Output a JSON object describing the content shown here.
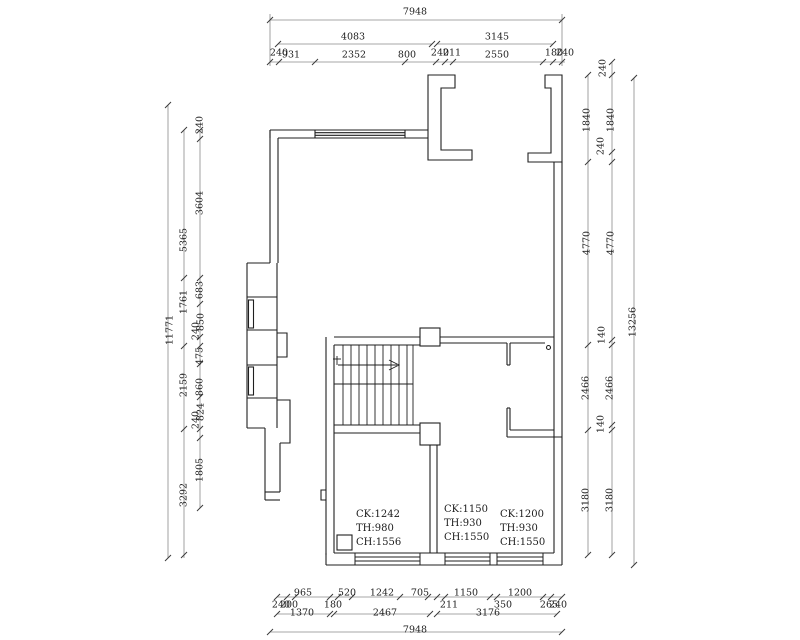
{
  "drawing_type": "floor-plan",
  "colors": {
    "wall_line": "#1f1f1f",
    "dim_line": "#6a6a6a",
    "text": "#1c1c1c",
    "background": "#ffffff"
  },
  "dimensions": {
    "top": {
      "total": "7948",
      "row2": [
        "4083",
        "3145"
      ],
      "row3": [
        "240",
        "931",
        "2352",
        "800",
        "240",
        "211",
        "2550",
        "180",
        "240"
      ]
    },
    "left": {
      "outer": "11771",
      "middle": [
        "5365",
        "1761",
        "2159",
        "3292"
      ],
      "inner": [
        "240",
        "3604",
        "683",
        "850",
        "240",
        "475",
        "860",
        "824",
        "240",
        "1805"
      ]
    },
    "right": {
      "outer": "13256",
      "inner": [
        "1840",
        "4770",
        "2466",
        "3180"
      ],
      "detail": [
        "240",
        "1840",
        "240",
        "4770",
        "140",
        "2466",
        "140",
        "3180"
      ]
    },
    "bottom": {
      "row1": [
        "240",
        "200",
        "965",
        "180",
        "520",
        "1242",
        "705",
        "211",
        "1150",
        "1200",
        "350",
        "265",
        "240"
      ],
      "row2": [
        "1370",
        "2467",
        "3176"
      ],
      "total": "7948"
    }
  },
  "annotations": {
    "window1": {
      "ck": "CK:1242",
      "th": "TH:980",
      "ch": "CH:1556"
    },
    "window2": {
      "ck": "CK:1150",
      "th": "TH:930",
      "ch": "CH:1550"
    },
    "window3": {
      "ck": "CK:1200",
      "th": "TH:930",
      "ch": "CH:1550"
    }
  }
}
